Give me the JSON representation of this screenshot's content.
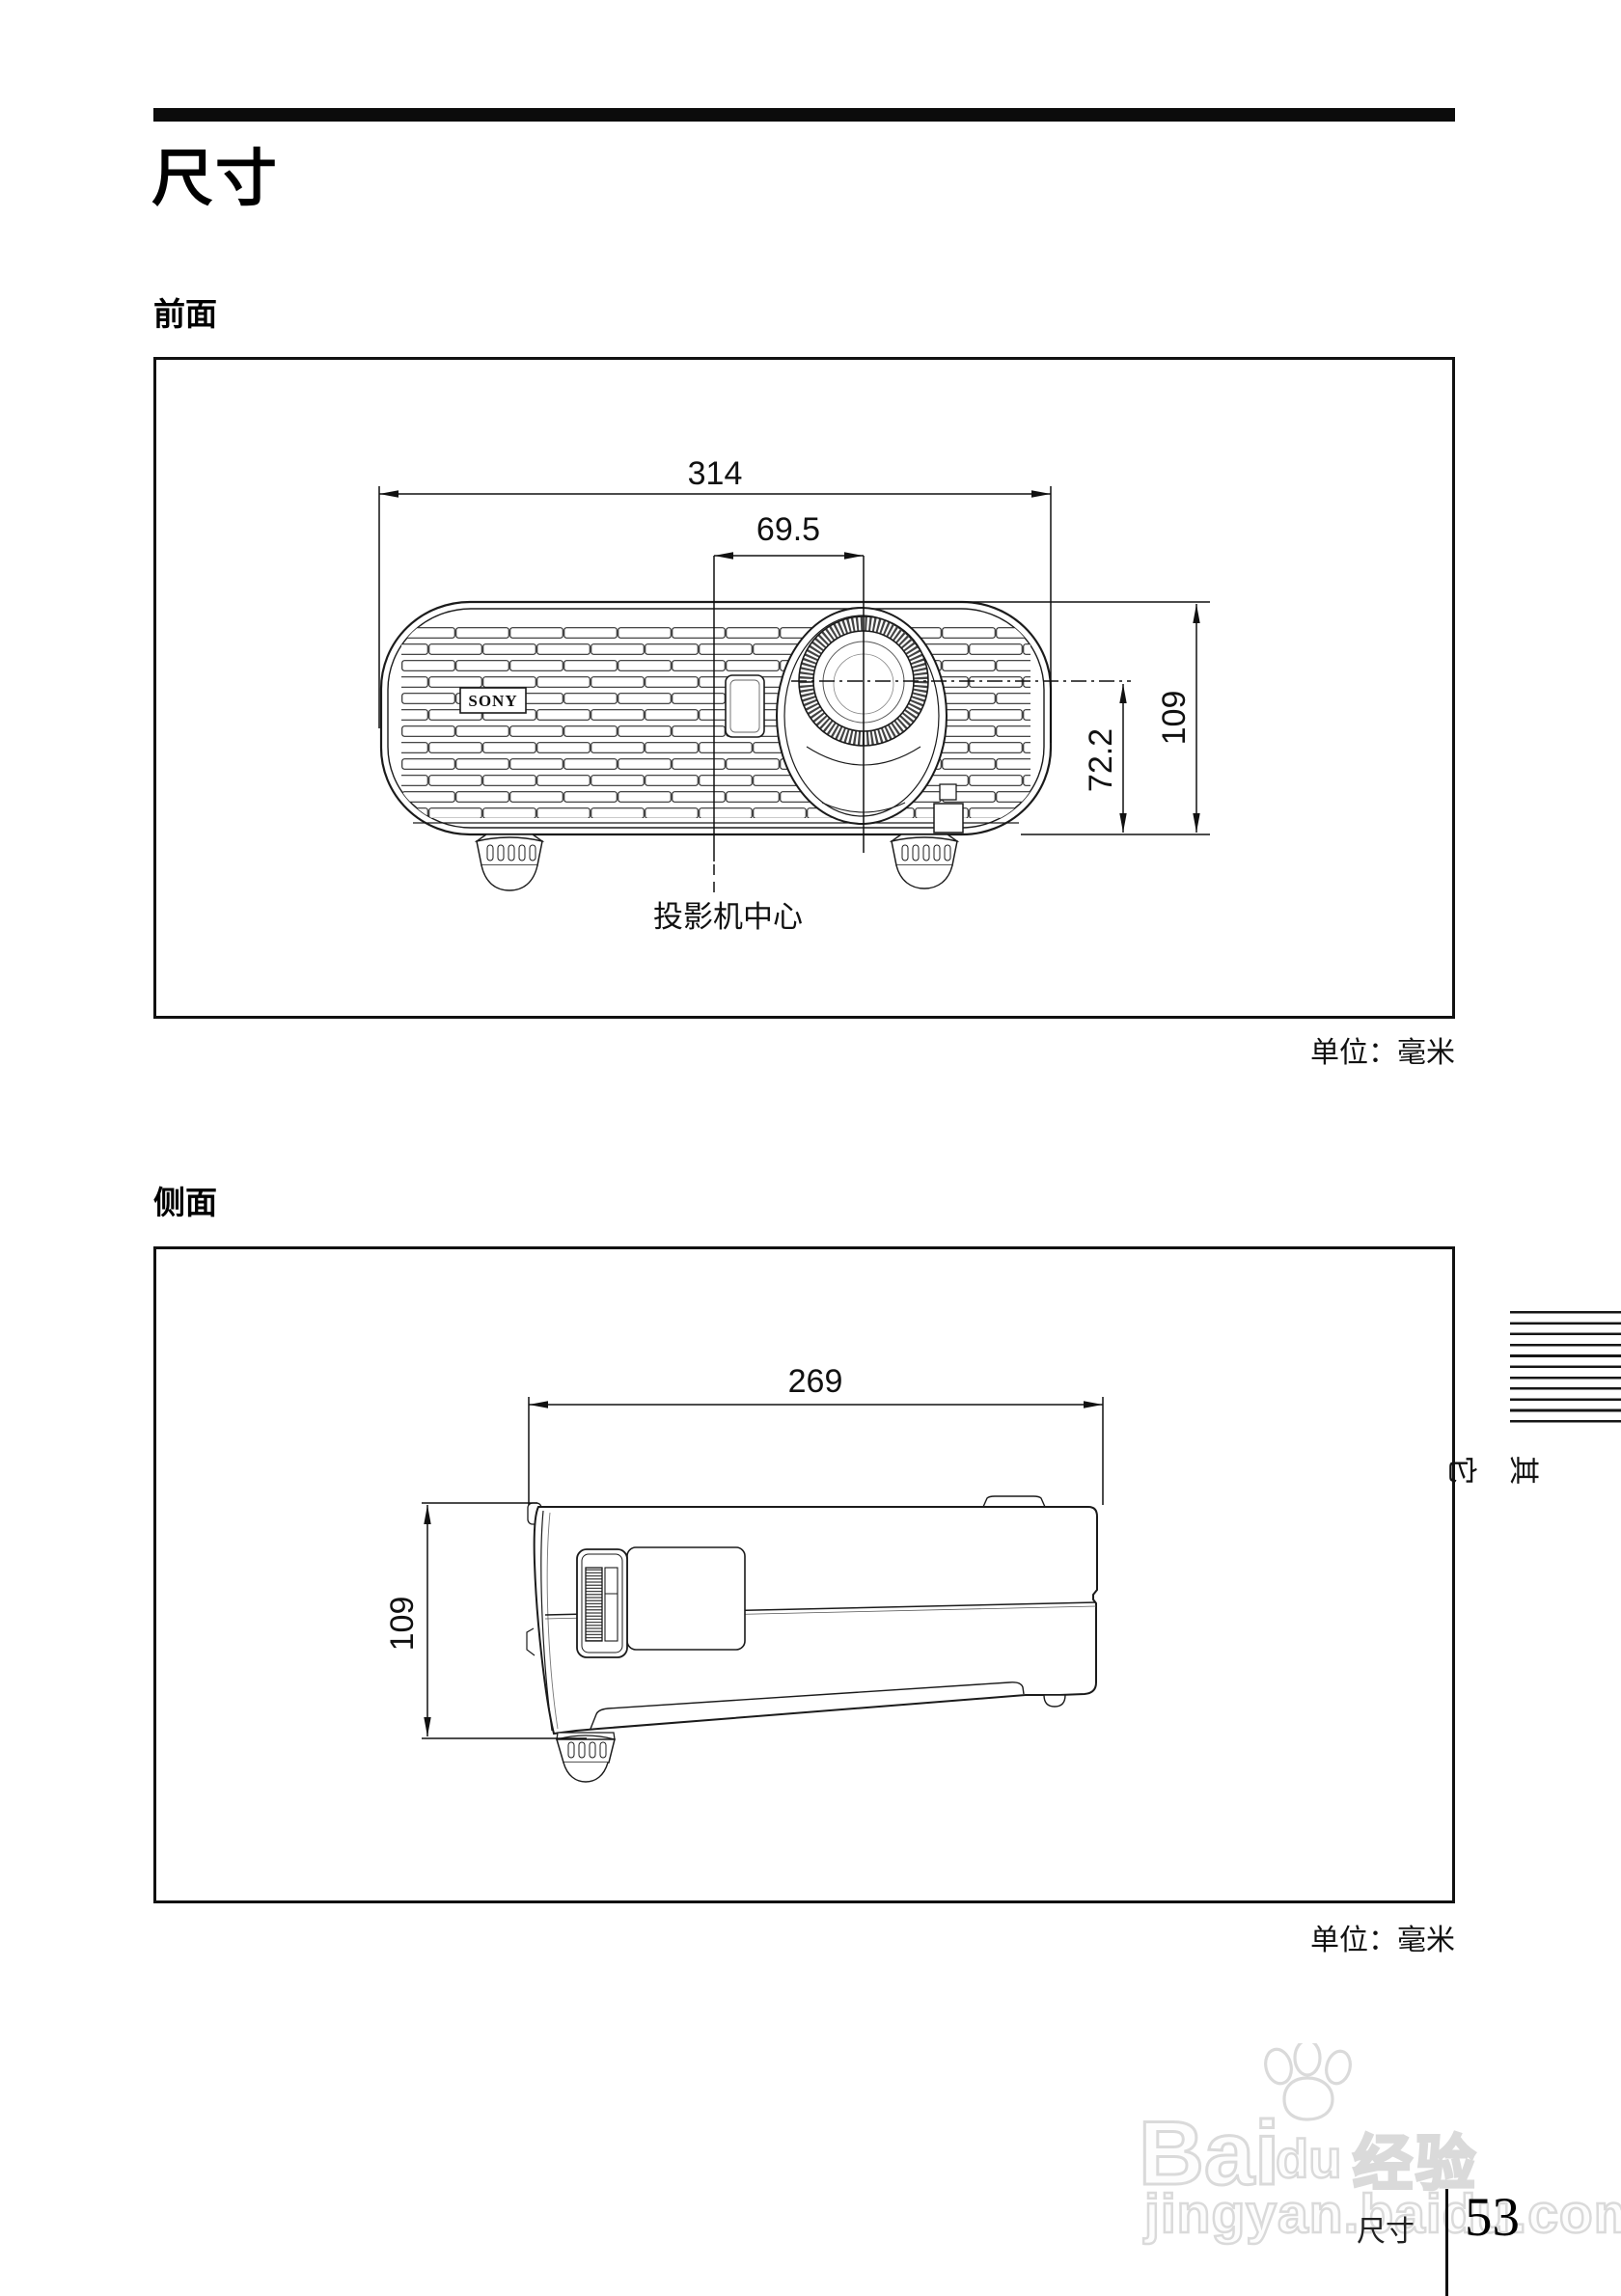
{
  "header": {
    "title": "尺寸"
  },
  "front_section": {
    "heading": "前面",
    "unit_label": "单位：毫米",
    "drawing": {
      "brand": "SONY",
      "width_mm": "314",
      "lens_offset_mm": "69.5",
      "height_mm": "109",
      "lens_center_height_mm": "72.2",
      "center_label": "投影机中心"
    }
  },
  "side_section": {
    "heading": "侧面",
    "unit_label": "单位：毫米",
    "drawing": {
      "depth_mm": "269",
      "height_mm": "109"
    }
  },
  "side_tab": {
    "label": "其它"
  },
  "watermark": {
    "brand_left": "Bai",
    "brand_right": "du",
    "suffix": "经验",
    "url": "jingyan.baidu.com"
  },
  "footer": {
    "chapter": "尺寸",
    "page_number": "53"
  }
}
